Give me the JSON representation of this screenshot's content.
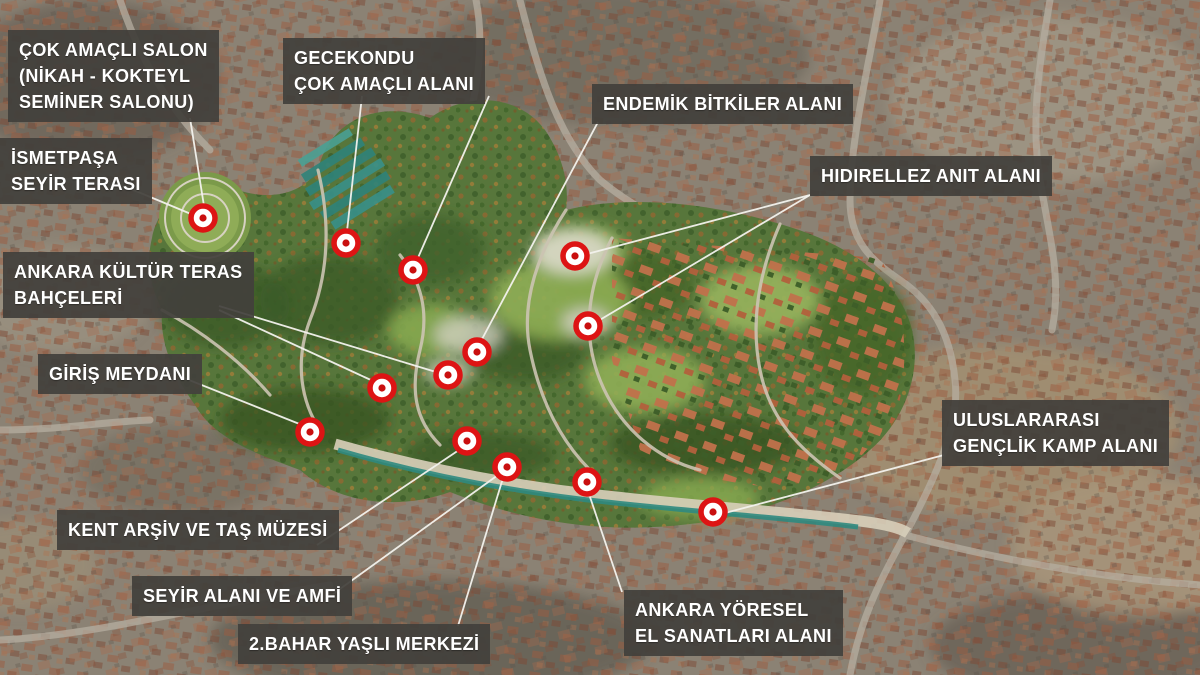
{
  "map": {
    "title": "Ankara park masterplan aerial annotation map",
    "colors": {
      "marker_red": "#dd1414",
      "marker_center": "#c90f0f",
      "marker_fill": "#ffffff",
      "leader_line": "#f4f3ee",
      "label_bg": "#42403c",
      "label_text": "#ffffff"
    },
    "annotations": [
      {
        "id": "cok-amacli-salon",
        "x": 8,
        "y": 30,
        "lines": [
          "ÇOK AMAÇLI SALON",
          "(NİKAH - KOKTEYL",
          "SEMİNER SALONU)"
        ]
      },
      {
        "id": "gecekondu",
        "x": 283,
        "y": 38,
        "lines": [
          "GECEKONDU",
          "ÇOK AMAÇLI ALANI"
        ]
      },
      {
        "id": "endemik-bitkiler",
        "x": 592,
        "y": 84,
        "lines": [
          "ENDEMİK BİTKİLER ALANI"
        ]
      },
      {
        "id": "ismetpasa",
        "x": 0,
        "y": 138,
        "lines": [
          "İSMETPAŞA",
          "SEYİR TERASI"
        ]
      },
      {
        "id": "hidirellez",
        "x": 810,
        "y": 156,
        "lines": [
          "HIDIRELLEZ ANIT ALANI"
        ]
      },
      {
        "id": "kultur-teras",
        "x": 3,
        "y": 252,
        "lines": [
          "ANKARA KÜLTÜR TERAS",
          "BAHÇELERİ"
        ]
      },
      {
        "id": "giris-meydani",
        "x": 38,
        "y": 354,
        "lines": [
          "GİRİŞ MEYDANI"
        ]
      },
      {
        "id": "uluslararasi-kamp",
        "x": 942,
        "y": 400,
        "lines": [
          "ULUSLARARASI",
          "GENÇLİK KAMP ALANI"
        ]
      },
      {
        "id": "kent-arsiv",
        "x": 57,
        "y": 510,
        "lines": [
          "KENT ARŞİV VE TAŞ MÜZESİ"
        ]
      },
      {
        "id": "seyir-alani",
        "x": 132,
        "y": 576,
        "lines": [
          "SEYİR ALANI VE AMFİ"
        ]
      },
      {
        "id": "yoresel-sanatlar",
        "x": 624,
        "y": 590,
        "lines": [
          "ANKARA YÖRESEL",
          "EL SANATLARI ALANI"
        ]
      },
      {
        "id": "bahar-yasli",
        "x": 238,
        "y": 624,
        "lines": [
          "2.BAHAR YAŞLI MERKEZİ"
        ]
      }
    ],
    "markers": [
      {
        "id": "m1",
        "x": 203,
        "y": 218
      },
      {
        "id": "m2",
        "x": 346,
        "y": 243
      },
      {
        "id": "m3",
        "x": 413,
        "y": 270
      },
      {
        "id": "m4",
        "x": 575,
        "y": 256
      },
      {
        "id": "m5",
        "x": 588,
        "y": 326
      },
      {
        "id": "m6",
        "x": 477,
        "y": 352
      },
      {
        "id": "m7",
        "x": 448,
        "y": 375
      },
      {
        "id": "m8",
        "x": 382,
        "y": 388
      },
      {
        "id": "m9",
        "x": 310,
        "y": 432
      },
      {
        "id": "m10",
        "x": 467,
        "y": 441
      },
      {
        "id": "m11",
        "x": 507,
        "y": 467
      },
      {
        "id": "m12",
        "x": 587,
        "y": 482
      },
      {
        "id": "m13",
        "x": 713,
        "y": 512
      }
    ],
    "leader_lines": [
      {
        "from": "cok-amacli-salon",
        "x1": 190,
        "y1": 118,
        "x2": 204,
        "y2": 206
      },
      {
        "from": "ismetpasa",
        "x1": 131,
        "y1": 189,
        "x2": 191,
        "y2": 214
      },
      {
        "from": "gecekondu",
        "x1": 362,
        "y1": 96,
        "x2": 347,
        "y2": 231
      },
      {
        "from": "gecekondu",
        "x1": 489,
        "y1": 96,
        "x2": 417,
        "y2": 260
      },
      {
        "from": "endemik-bitkiler",
        "x1": 598,
        "y1": 122,
        "x2": 481,
        "y2": 341
      },
      {
        "from": "hidirellez",
        "x1": 810,
        "y1": 195,
        "x2": 587,
        "y2": 254
      },
      {
        "from": "hidirellez",
        "x1": 810,
        "y1": 195,
        "x2": 598,
        "y2": 321
      },
      {
        "from": "kultur-teras",
        "x1": 219,
        "y1": 306,
        "x2": 436,
        "y2": 372
      },
      {
        "from": "kultur-teras",
        "x1": 219,
        "y1": 310,
        "x2": 373,
        "y2": 381
      },
      {
        "from": "giris-meydani",
        "x1": 184,
        "y1": 378,
        "x2": 302,
        "y2": 425
      },
      {
        "from": "kent-arsiv",
        "x1": 317,
        "y1": 545,
        "x2": 459,
        "y2": 450
      },
      {
        "from": "seyir-alani",
        "x1": 333,
        "y1": 594,
        "x2": 498,
        "y2": 475
      },
      {
        "from": "bahar-yasli",
        "x1": 458,
        "y1": 626,
        "x2": 503,
        "y2": 478
      },
      {
        "from": "yoresel-sanatlar",
        "x1": 622,
        "y1": 592,
        "x2": 589,
        "y2": 494
      },
      {
        "from": "uluslararasi-kamp",
        "x1": 944,
        "y1": 455,
        "x2": 725,
        "y2": 513
      }
    ]
  }
}
